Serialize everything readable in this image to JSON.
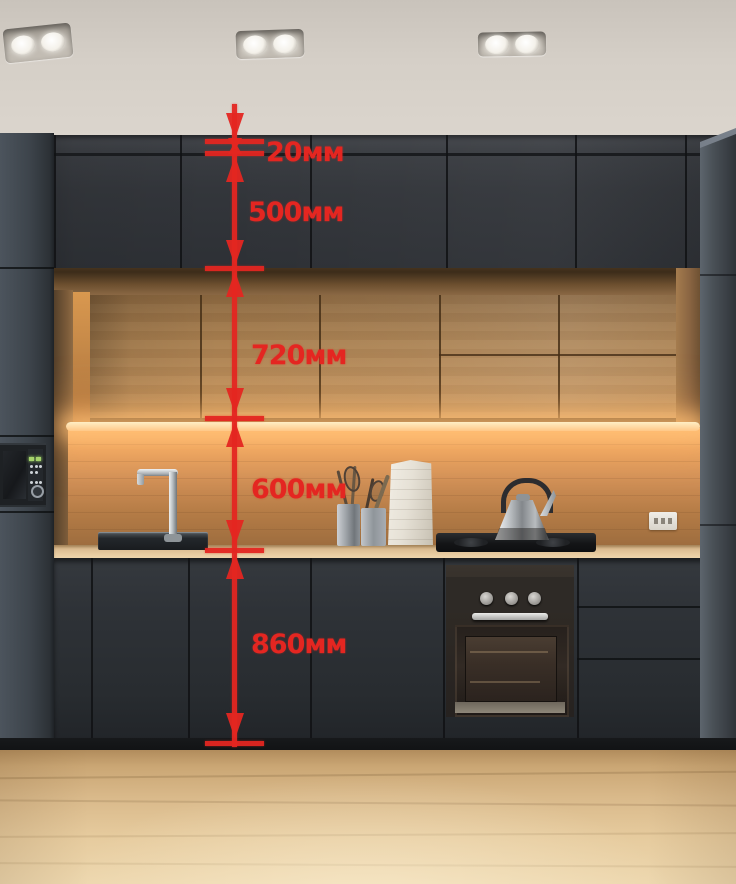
{
  "accent_color": "#e42621",
  "dimension_overlay": {
    "unit": "мм",
    "segments": [
      "20мм",
      "500мм",
      "720мм",
      "600мм",
      "860мм"
    ]
  }
}
